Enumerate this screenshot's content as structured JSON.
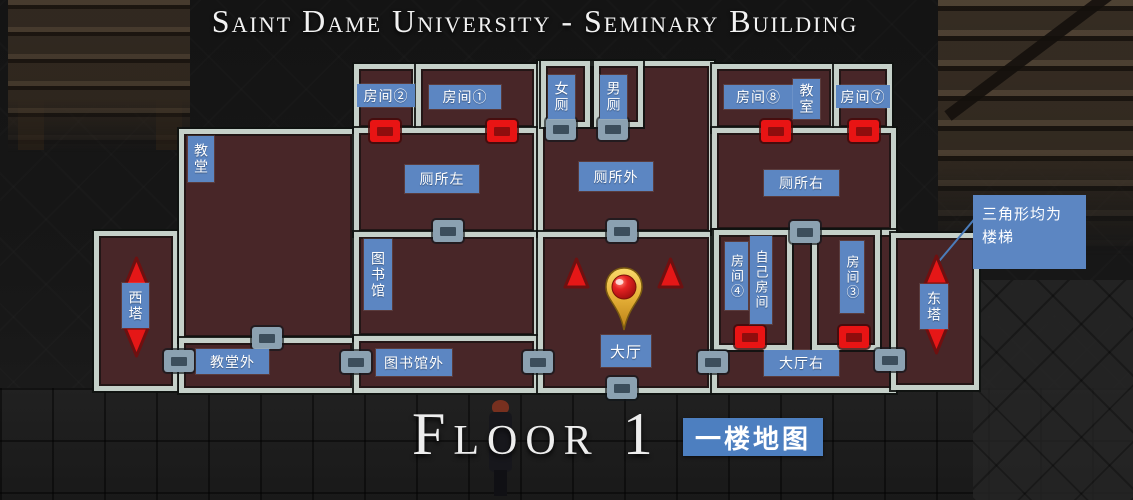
{
  "header": {
    "title": "Saint Dame University - Seminary Building"
  },
  "rooms": {
    "chapel": "教堂",
    "west_tower": "西塔",
    "chapel_outside": "教堂外",
    "room2": "房间②",
    "room1": "房间①",
    "toilet_left": "厕所左",
    "library": "图书馆",
    "library_outside": "图书馆外",
    "women_toilet": "女厕",
    "men_toilet": "男厕",
    "toilet_outside": "厕所外",
    "hall": "大厅",
    "room8": "房间⑧",
    "classroom": "教室",
    "room7": "房间⑦",
    "toilet_right": "厕所右",
    "room4": "房间④",
    "own_room": "自己房间",
    "room3": "房间③",
    "hall_right": "大厅右",
    "east_tower": "东塔"
  },
  "legend": {
    "note": "三角形均为\n楼梯"
  },
  "footer": {
    "floor_title": "Floor 1",
    "floor_badge": "一楼地图"
  },
  "colors": {
    "label_bg": "#5c86c2",
    "badge_bg": "#4d7fc0",
    "wall": "#c5d0c9",
    "room_fill": "#482628",
    "door_red": "#e81414",
    "door_gray": "#8ba1b1",
    "stair_triangle": "#e51717"
  }
}
